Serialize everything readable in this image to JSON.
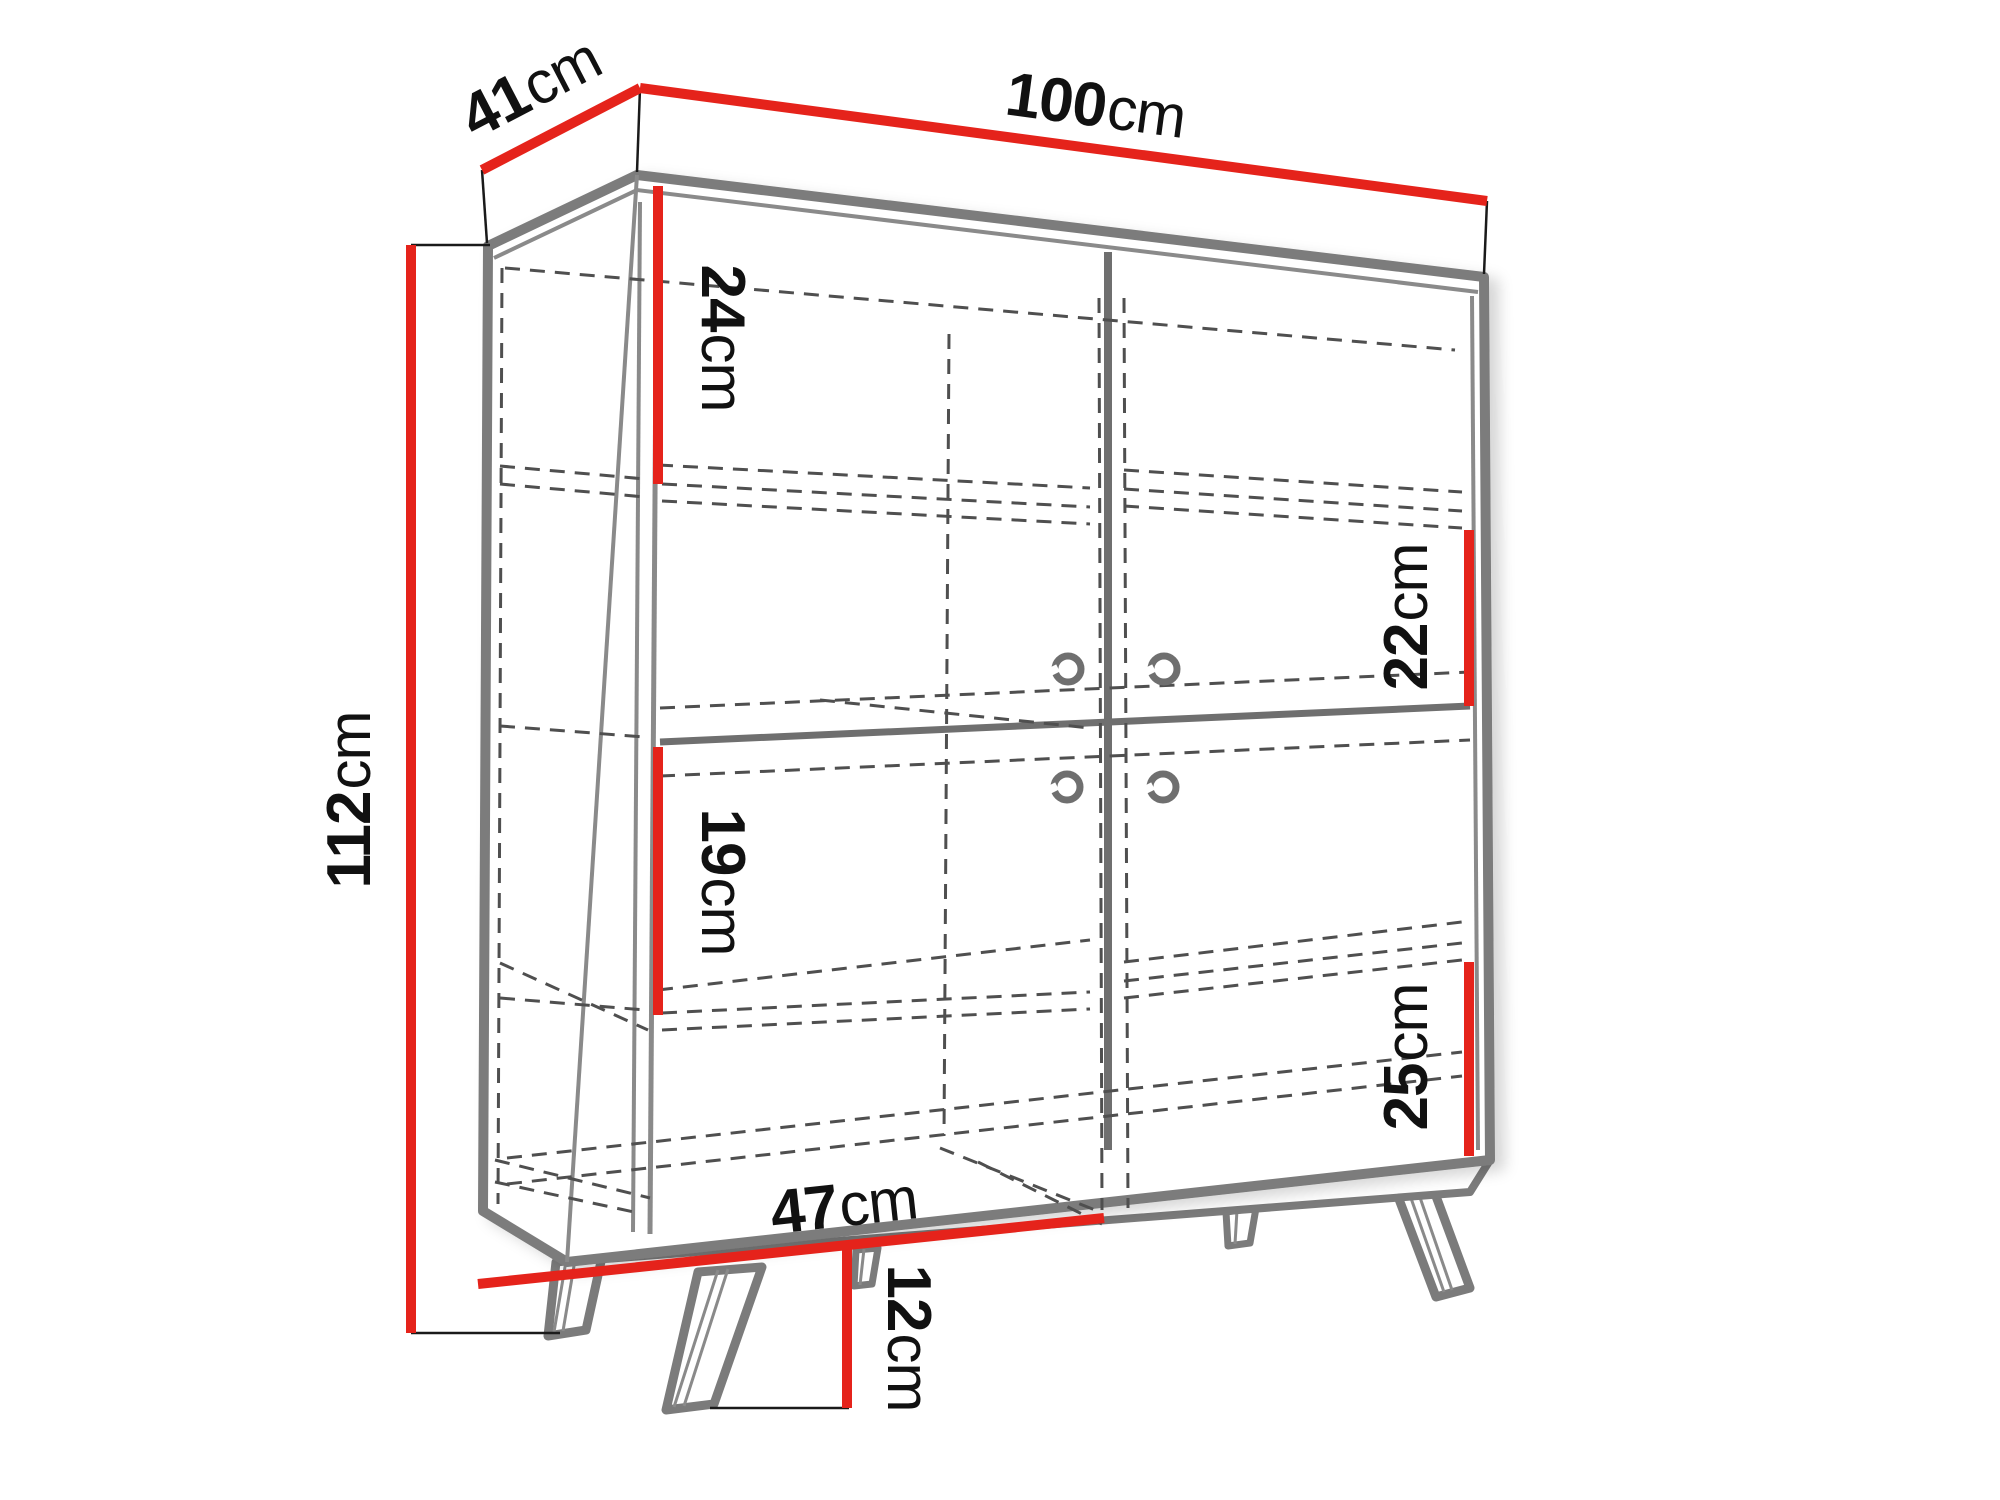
{
  "diagram": {
    "title": "cabinet-dimension-drawing",
    "subject": "two-door sideboard cabinet with four inner compartments, ring handles and splayed legs",
    "unit": "cm",
    "colors": {
      "dimension_line": "#e5231b",
      "outline_gray": "#7b7b7b",
      "dashed_gray": "#4f4f4f",
      "label_text": "#111111",
      "background": "#ffffff"
    },
    "dimensions": {
      "depth": {
        "value": "41",
        "unit": "cm",
        "meaning": "cabinet depth (top left edge)"
      },
      "width": {
        "value": "100",
        "unit": "cm",
        "meaning": "cabinet width (top edge)"
      },
      "height": {
        "value": "112",
        "unit": "cm",
        "meaning": "total cabinet height (left side)"
      },
      "top_section": {
        "value": "24",
        "unit": "cm",
        "meaning": "upper left compartment height"
      },
      "upper_right": {
        "value": "22",
        "unit": "cm",
        "meaning": "upper right compartment height"
      },
      "middle_left": {
        "value": "19",
        "unit": "cm",
        "meaning": "middle left compartment height"
      },
      "lower_right": {
        "value": "25",
        "unit": "cm",
        "meaning": "lower right compartment height"
      },
      "door_width": {
        "value": "47",
        "unit": "cm",
        "meaning": "door width (bottom front edge)"
      },
      "leg_height": {
        "value": "12",
        "unit": "cm",
        "meaning": "leg height"
      }
    }
  }
}
